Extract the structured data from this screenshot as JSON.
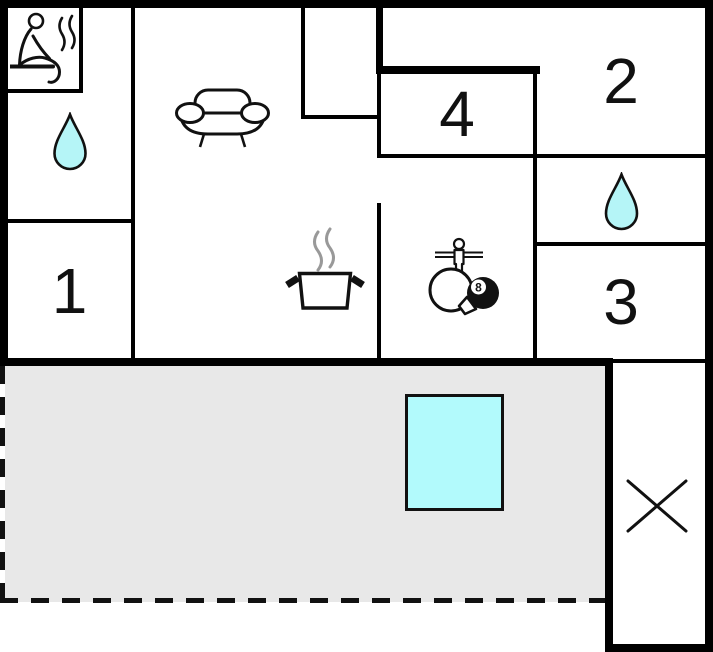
{
  "plan": {
    "name": "holiday-home-floor-plan",
    "rooms": [
      {
        "id": "room-1",
        "label": "1"
      },
      {
        "id": "room-2",
        "label": "2"
      },
      {
        "id": "room-3",
        "label": "3"
      },
      {
        "id": "room-4",
        "label": "4"
      }
    ],
    "ball": {
      "label": "8"
    },
    "icons": [
      "sauna-icon",
      "water-drop-icon-left",
      "water-drop-icon-right",
      "sofa-icon",
      "cooking-pot-icon",
      "games-icon",
      "cross-icon"
    ],
    "areas": [
      "terrace",
      "pool"
    ],
    "colors": {
      "wall": "#000000",
      "water_fill": "#b5f5f7",
      "pool_fill": "#b2fafc",
      "terrace_fill": "#e8e8e8",
      "steam_gray": "#999999"
    }
  }
}
